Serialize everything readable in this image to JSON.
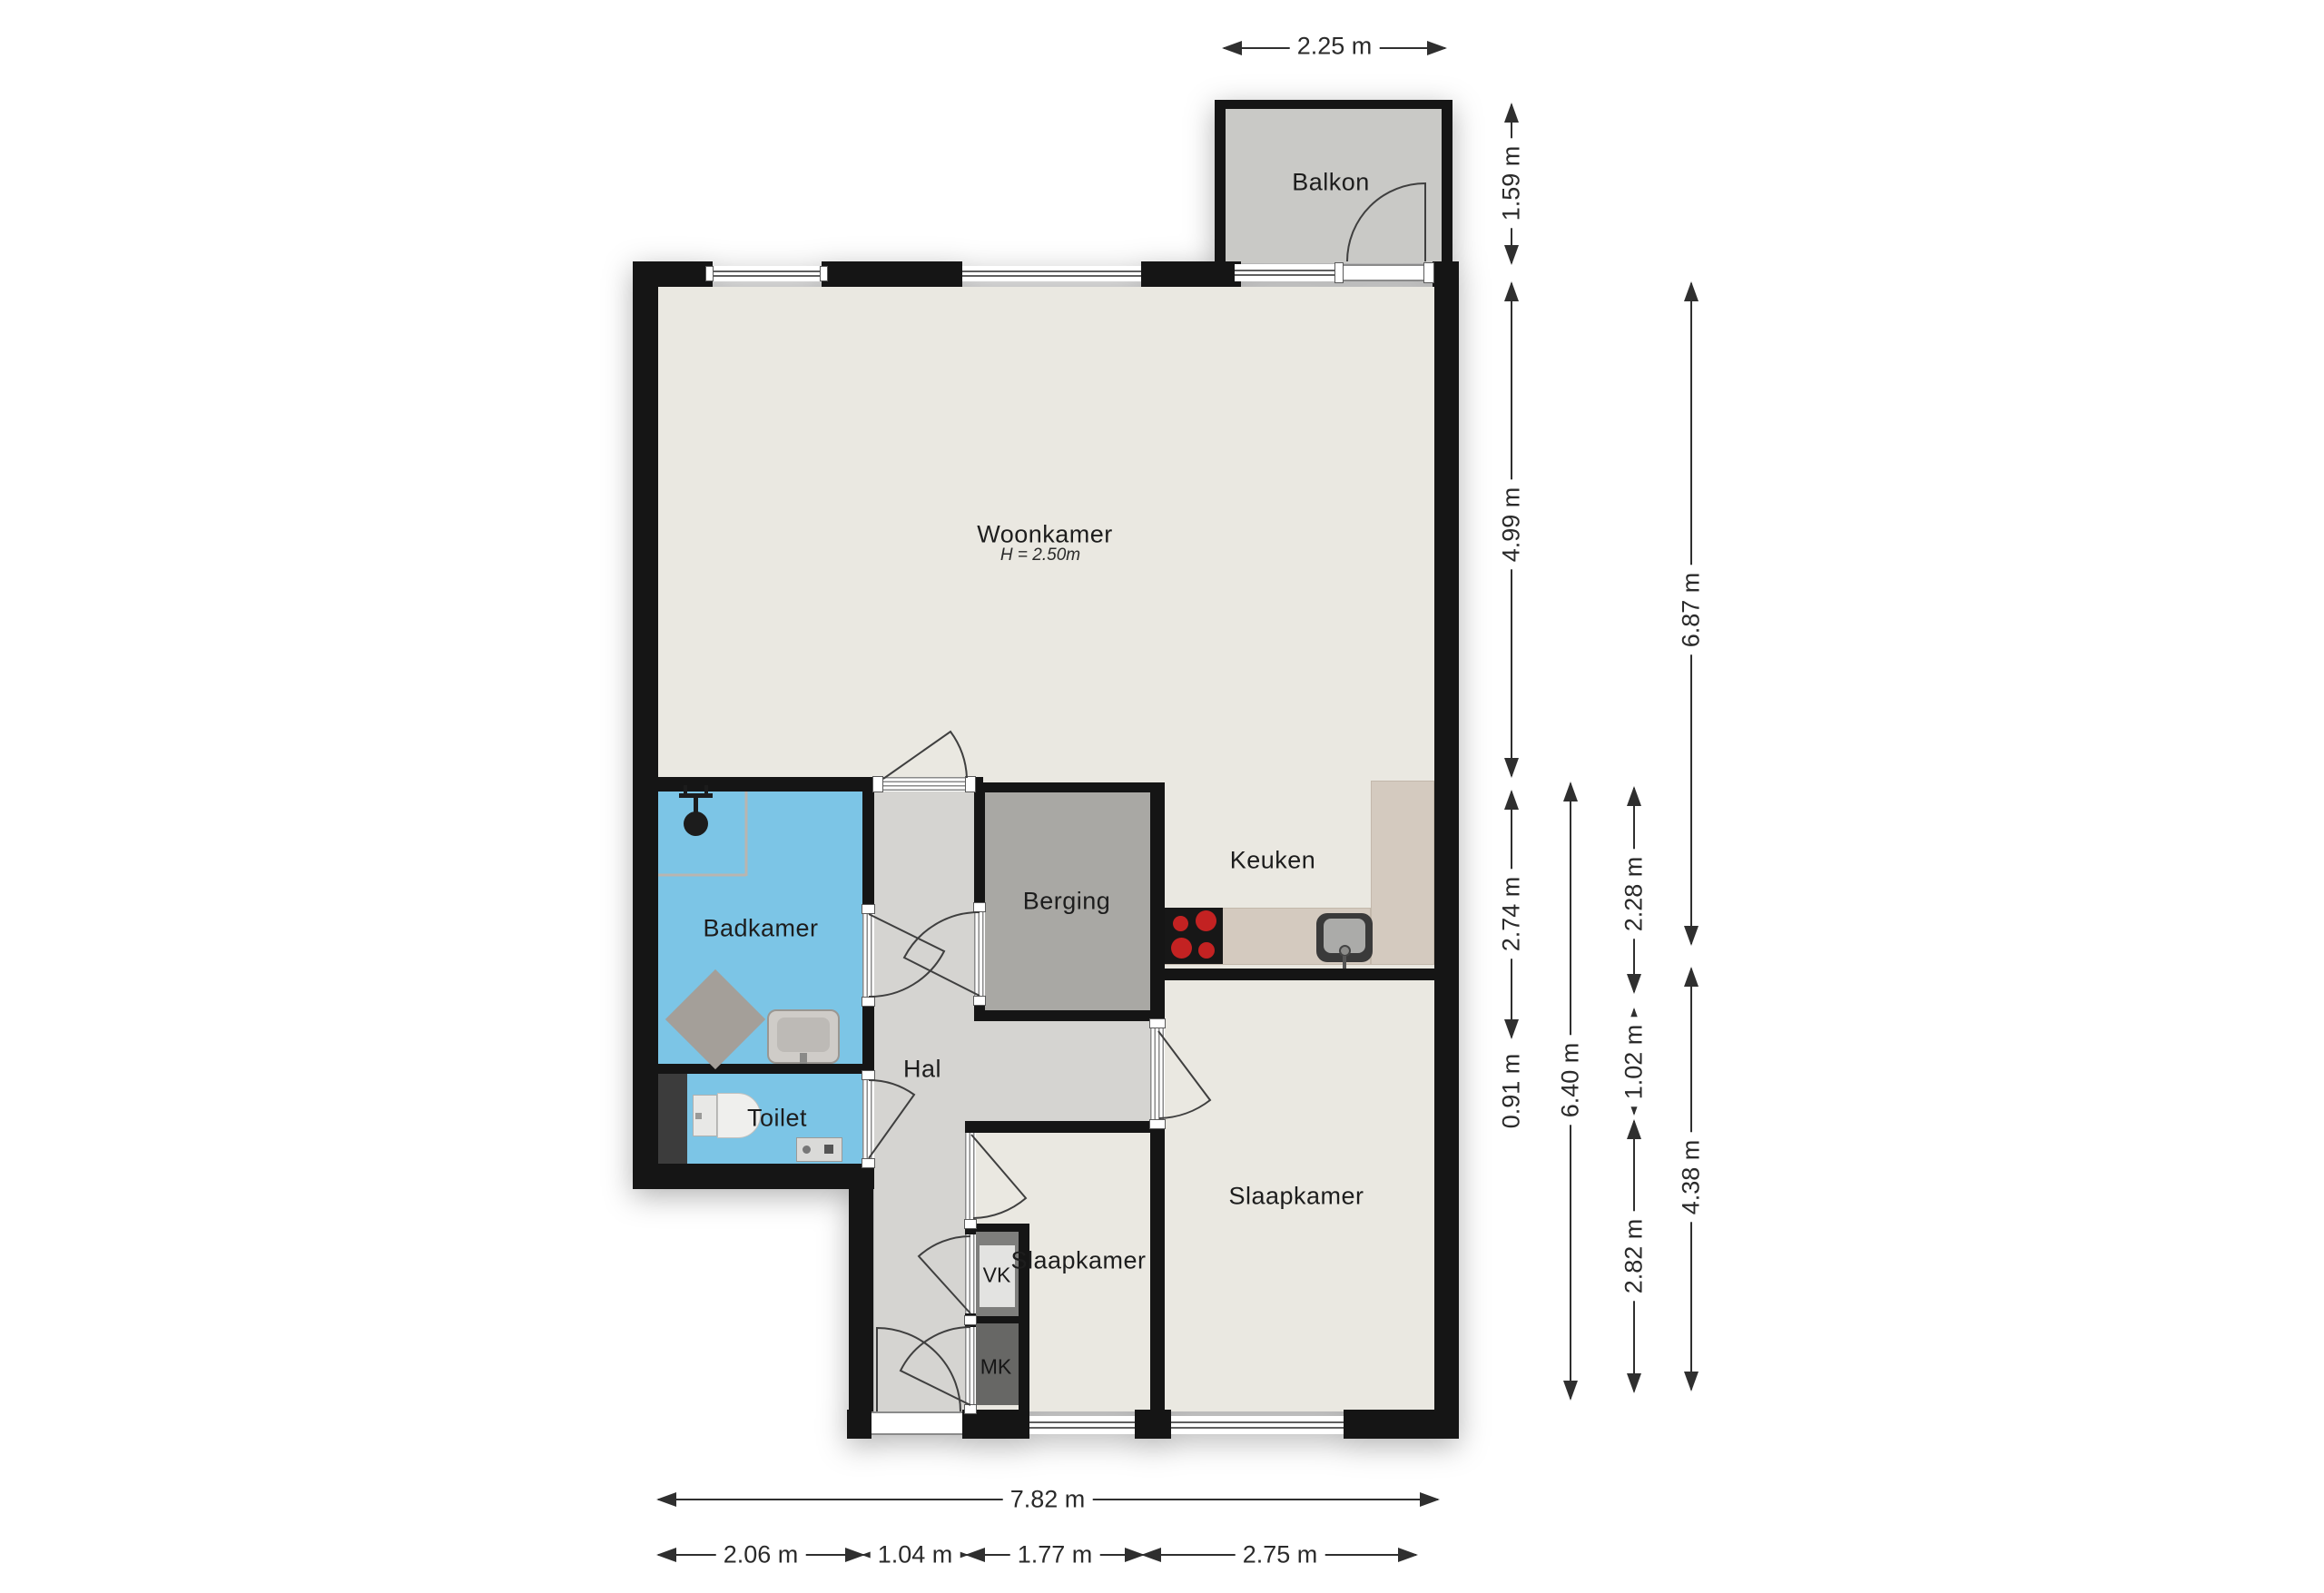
{
  "rooms": {
    "woonkamer": {
      "label": "Woonkamer",
      "sublabel": "H = 2.50m"
    },
    "keuken": {
      "label": "Keuken"
    },
    "berging": {
      "label": "Berging"
    },
    "hal": {
      "label": "Hal"
    },
    "badkamer": {
      "label": "Badkamer"
    },
    "toilet": {
      "label": "Toilet"
    },
    "slaapkamer_klein": {
      "label": "Slaapkamer"
    },
    "slaapkamer": {
      "label": "Slaapkamer"
    },
    "balkon": {
      "label": "Balkon"
    },
    "vk": {
      "label": "VK"
    },
    "mk": {
      "label": "MK"
    }
  },
  "dimensions": {
    "top": {
      "balkon_width": "2.25 m"
    },
    "right": {
      "balkon_depth": "1.59 m",
      "woonkamer_depth": "4.99 m",
      "keuken_depth": "2.74 m",
      "toilet_depth": "0.91 m",
      "mid_total": "6.40 m",
      "keuken_inner": "2.28 m",
      "hal_depth": "1.02 m",
      "slaapkamer_klein_depth": "2.82 m",
      "upper_total": "6.87 m",
      "slaapkamer_depth": "4.38 m"
    },
    "bottom": {
      "total": "7.82 m",
      "badkamer_width": "2.06 m",
      "hal_width": "1.04 m",
      "slaapkamer_klein_width": "1.77 m",
      "slaapkamer_width": "2.75 m"
    }
  },
  "colors": {
    "wall": "#151515",
    "living_floor": "#eae8e1",
    "hall_floor": "#d5d4d1",
    "storage_floor": "#a9a8a4",
    "balcony_floor": "#c9c9c6",
    "wet_room_floor": "#7cc5e6",
    "counter": "#d4cabf",
    "burner_red": "#c32222"
  }
}
